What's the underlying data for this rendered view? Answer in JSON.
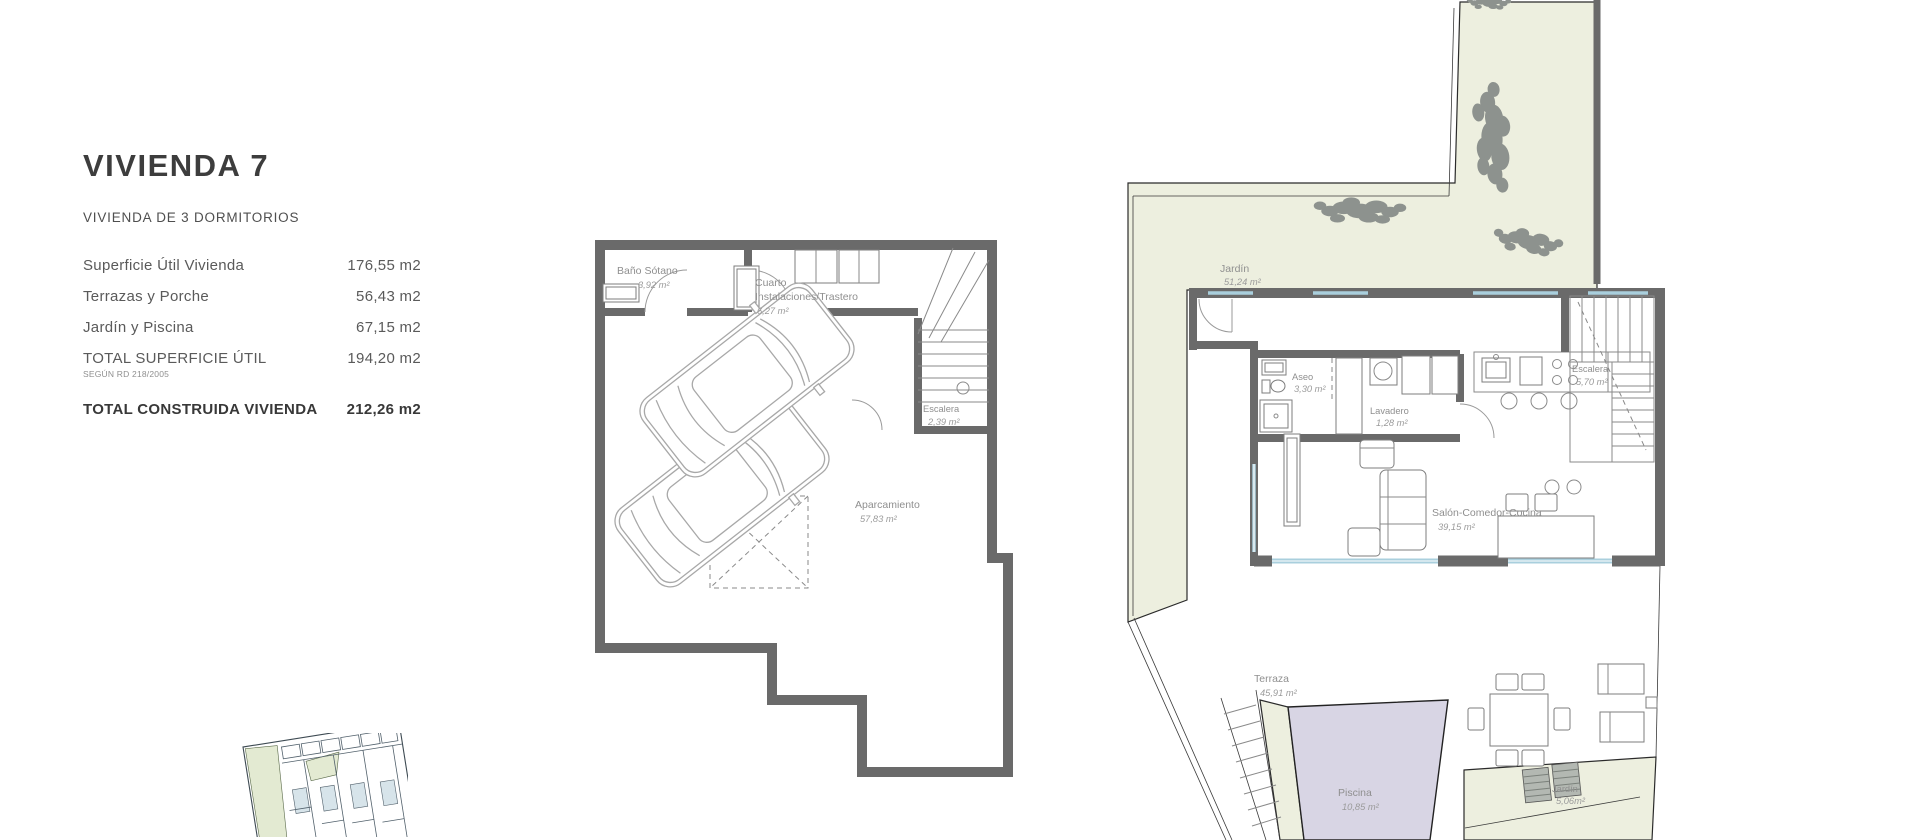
{
  "info_panel": {
    "title": "VIVIENDA 7",
    "subtitle": "VIVIENDA DE 3 DORMITORIOS",
    "rows": [
      {
        "label": "Superficie Útil Vivienda",
        "value": "176,55 m2"
      },
      {
        "label": "Terrazas y Porche",
        "value": "56,43 m2"
      },
      {
        "label": "Jardín y Piscina",
        "value": "67,15 m2"
      },
      {
        "label": "TOTAL SUPERFICIE ÚTIL",
        "note": "SEGÚN RD 218/2005",
        "value": "194,20 m2"
      },
      {
        "label": "TOTAL CONSTRUIDA VIVIENDA",
        "value": "212,26 m2"
      }
    ]
  },
  "basement_plan": {
    "rooms": {
      "bano": {
        "name": "Baño Sótano",
        "area": "3,92 m²"
      },
      "cuarto": {
        "name_line1": "Cuarto",
        "name_line2": "Instalaciones/Trastero",
        "area": "6,27 m²"
      },
      "escalera": {
        "name": "Escalera",
        "area": "2,39 m²"
      },
      "aparcamiento": {
        "name": "Aparcamiento",
        "area": "57,83 m²"
      }
    }
  },
  "ground_floor_plan": {
    "rooms": {
      "jardin_main": {
        "name": "Jardín",
        "area": "51,24 m²"
      },
      "aseo": {
        "name": "Aseo",
        "area": "3,30 m²"
      },
      "lavadero": {
        "name": "Lavadero",
        "area": "1,28 m²"
      },
      "escalera": {
        "name": "Escalera",
        "area": "5,70 m²"
      },
      "salon": {
        "name": "Salón-Comedor-Cocina",
        "area": "39,15 m²"
      },
      "terraza": {
        "name": "Terraza",
        "area": "45,91 m²"
      },
      "piscina": {
        "name": "Piscina",
        "area": "10,85 m²"
      },
      "jardin_small": {
        "name": "Jardín",
        "area": "5,06m²"
      }
    }
  },
  "colors": {
    "wall": "#6a6a6a",
    "garden_fill": "#edefdf",
    "pool_fill": "#d8d5e4",
    "glazing": "#a9cfdd",
    "plan_label_text": "#8f8f8f",
    "panel_text": "#5a5a5a",
    "title_text": "#3d3d3d"
  }
}
